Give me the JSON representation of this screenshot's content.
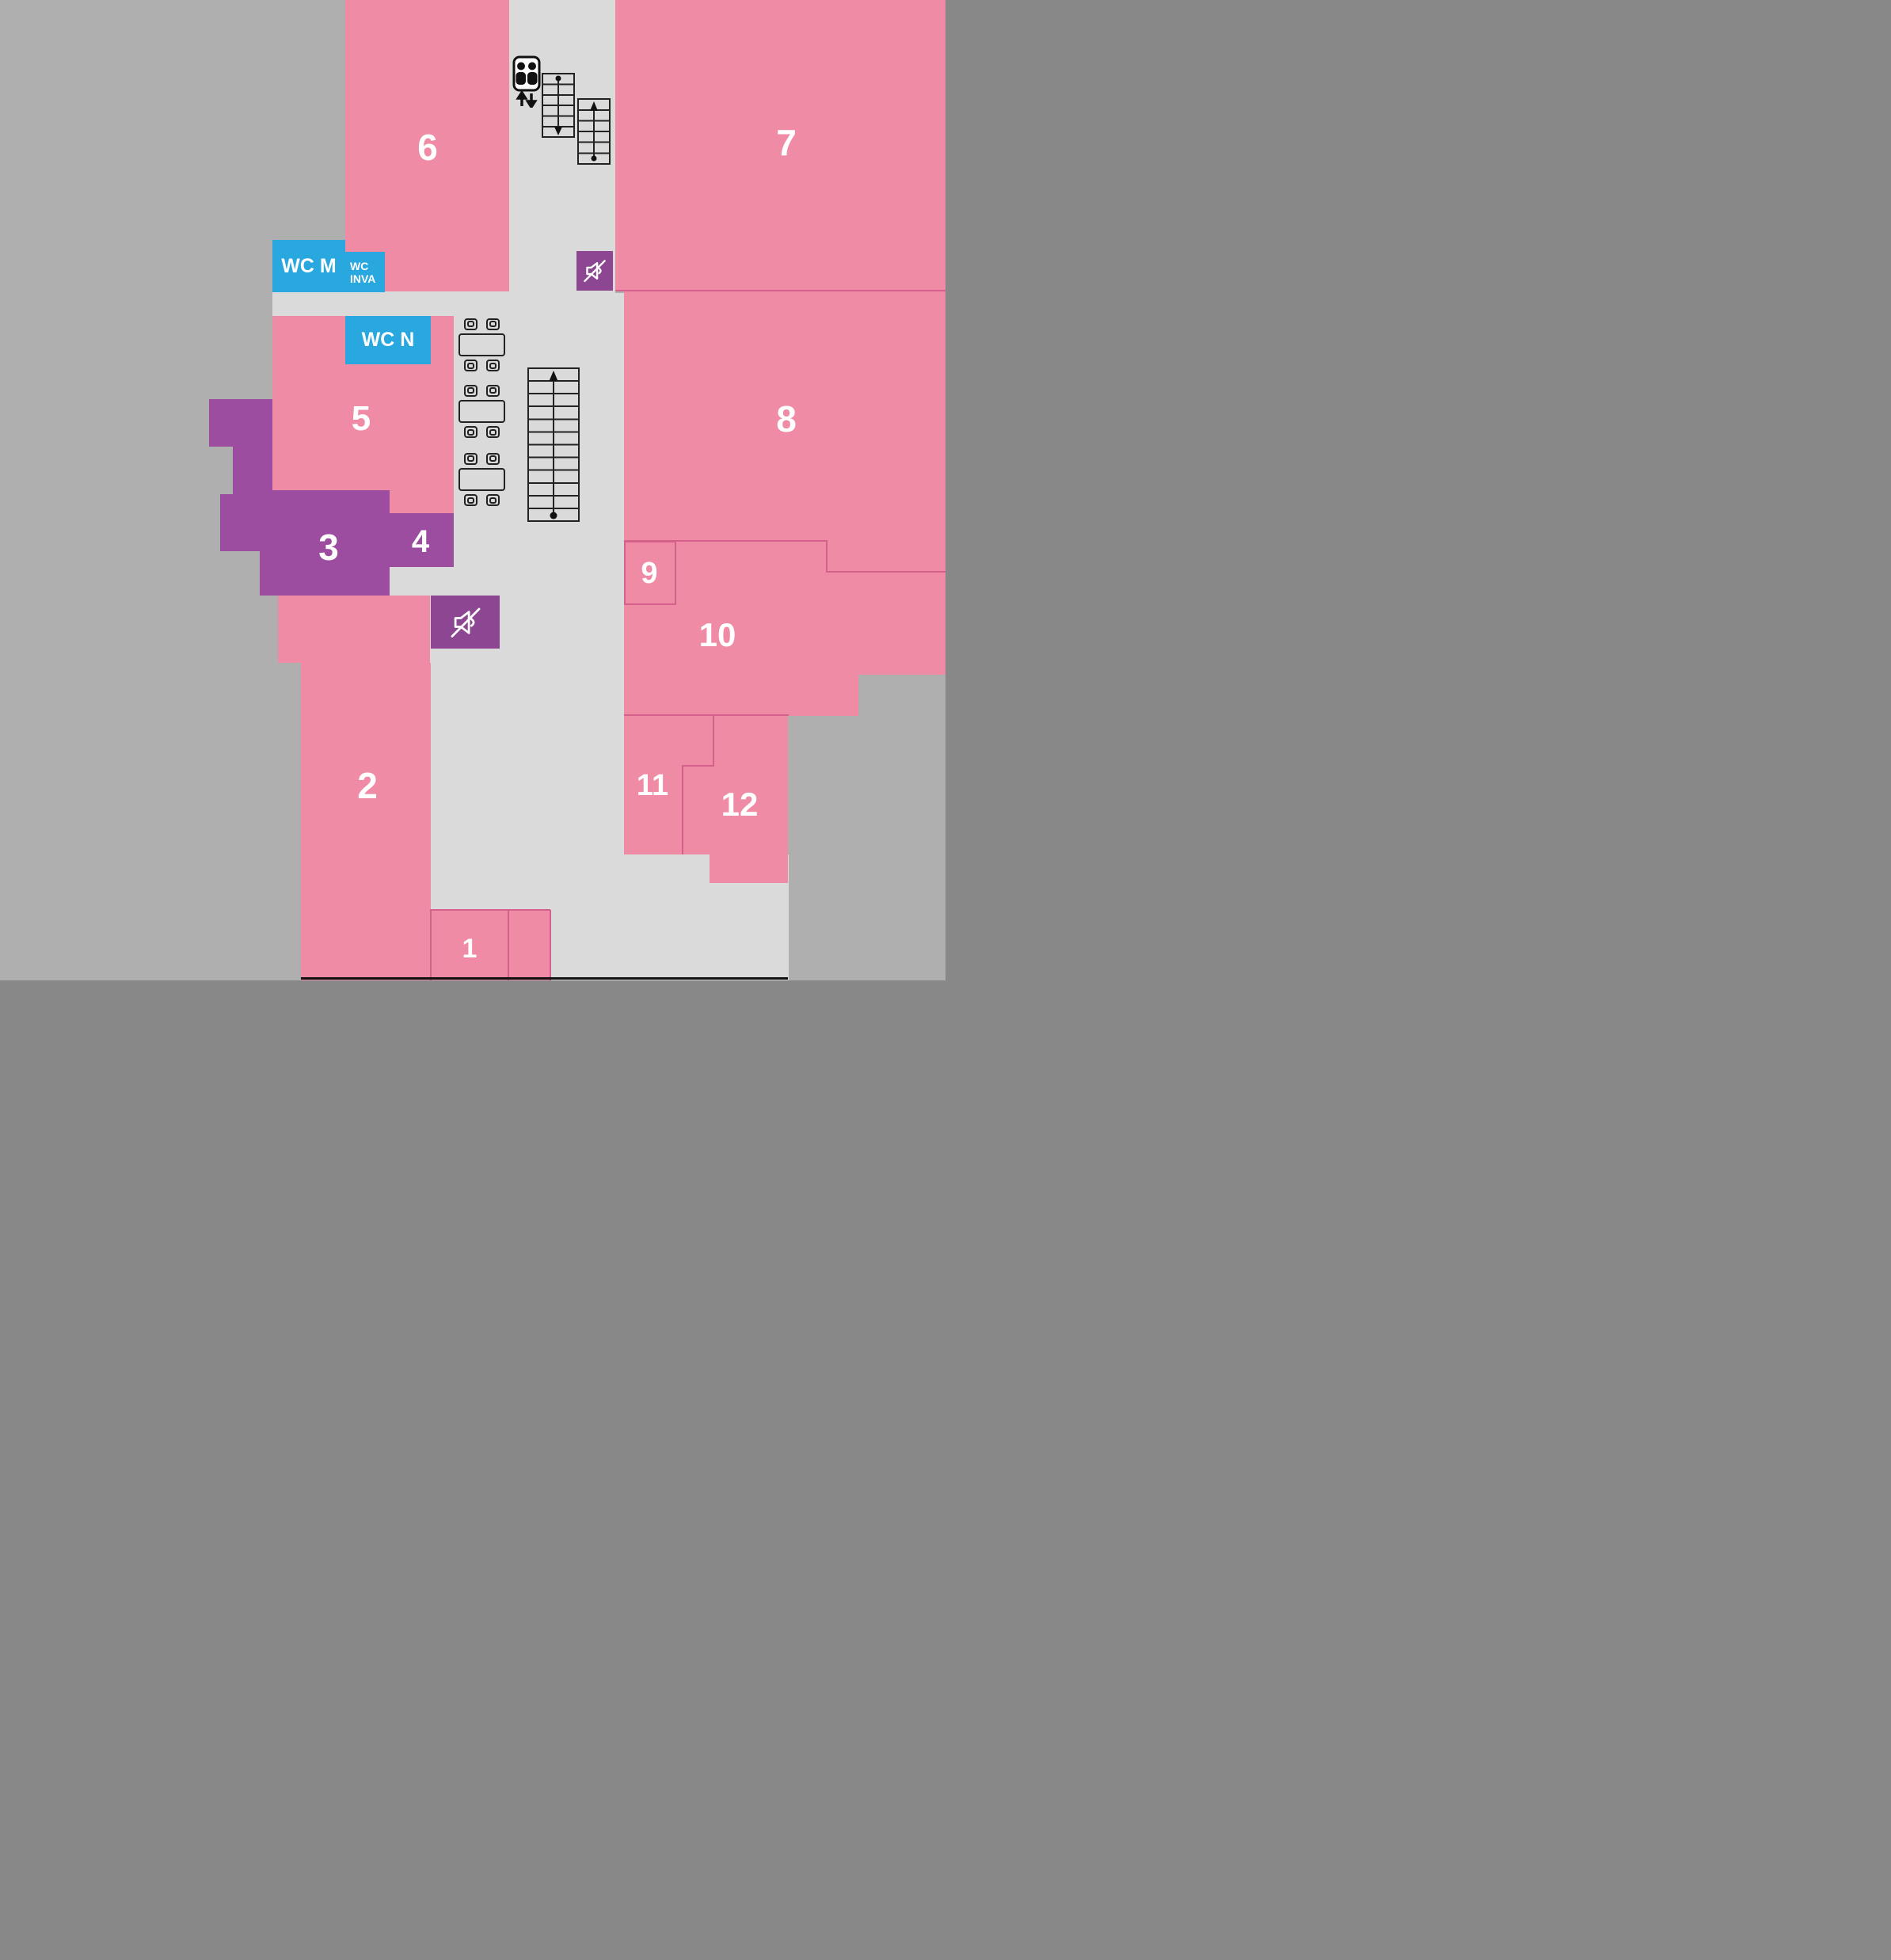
{
  "title": "Floor plan with numbered rooms",
  "colors": {
    "bgDark": "#afafaf",
    "corridor": "#dadada",
    "pink": "#ef8ba4",
    "line": "#d4618c",
    "purple": "#9c4da0",
    "purpleDark": "#8d4691",
    "blue": "#29a7df",
    "white": "#ffffff",
    "black": "#111111",
    "ink": "#222222"
  },
  "rooms": {
    "1": {
      "label": "1"
    },
    "2": {
      "label": "2"
    },
    "3": {
      "label": "3"
    },
    "4": {
      "label": "4"
    },
    "5": {
      "label": "5"
    },
    "6": {
      "label": "6"
    },
    "7": {
      "label": "7"
    },
    "8": {
      "label": "8"
    },
    "9": {
      "label": "9"
    },
    "10": {
      "label": "10"
    },
    "11": {
      "label": "11"
    },
    "12": {
      "label": "12"
    }
  },
  "wc": {
    "m": {
      "label": "WC M"
    },
    "inva": {
      "line1": "WC",
      "line2": "INVA"
    },
    "n": {
      "label": "WC N"
    }
  },
  "icons": {
    "mute": "muted-speaker",
    "elevator": "elevator-with-people",
    "elevator_arrows": "up-down-arrows",
    "stairs_small_down": "staircase-going-down",
    "stairs_small_up": "staircase-going-up",
    "stairs_large_up": "staircase-going-up",
    "furniture": "table-with-four-chairs"
  }
}
